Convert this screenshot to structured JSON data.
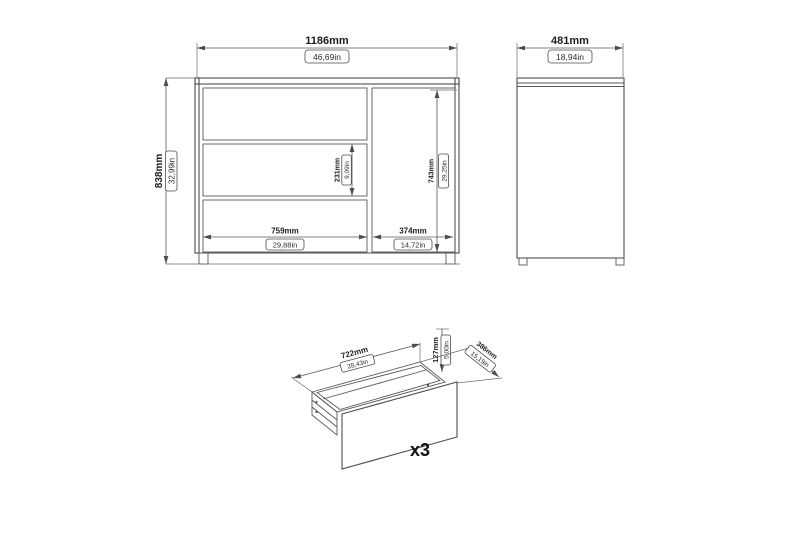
{
  "colors": {
    "background": "#ffffff",
    "line": "#4d4d4d",
    "text": "#1d1d1d"
  },
  "front_view": {
    "width_mm": "1186mm",
    "width_in": "46,69in",
    "height_mm": "838mm",
    "height_in": "32,99in",
    "middle_drawer_mm": "231mm",
    "middle_drawer_in": "9,09in",
    "door_height_mm": "743mm",
    "door_height_in": "29,25in",
    "drawer_section_mm": "759mm",
    "drawer_section_in": "29,88in",
    "door_section_mm": "374mm",
    "door_section_in": "14,72in"
  },
  "side_view": {
    "depth_mm": "481mm",
    "depth_in": "18,94in"
  },
  "drawer_view": {
    "width_mm": "722mm",
    "width_in": "28,43in",
    "height_mm": "127mm",
    "height_in": "5,00in",
    "depth_mm": "386mm",
    "depth_in": "15,19in",
    "quantity_label": "x3"
  }
}
